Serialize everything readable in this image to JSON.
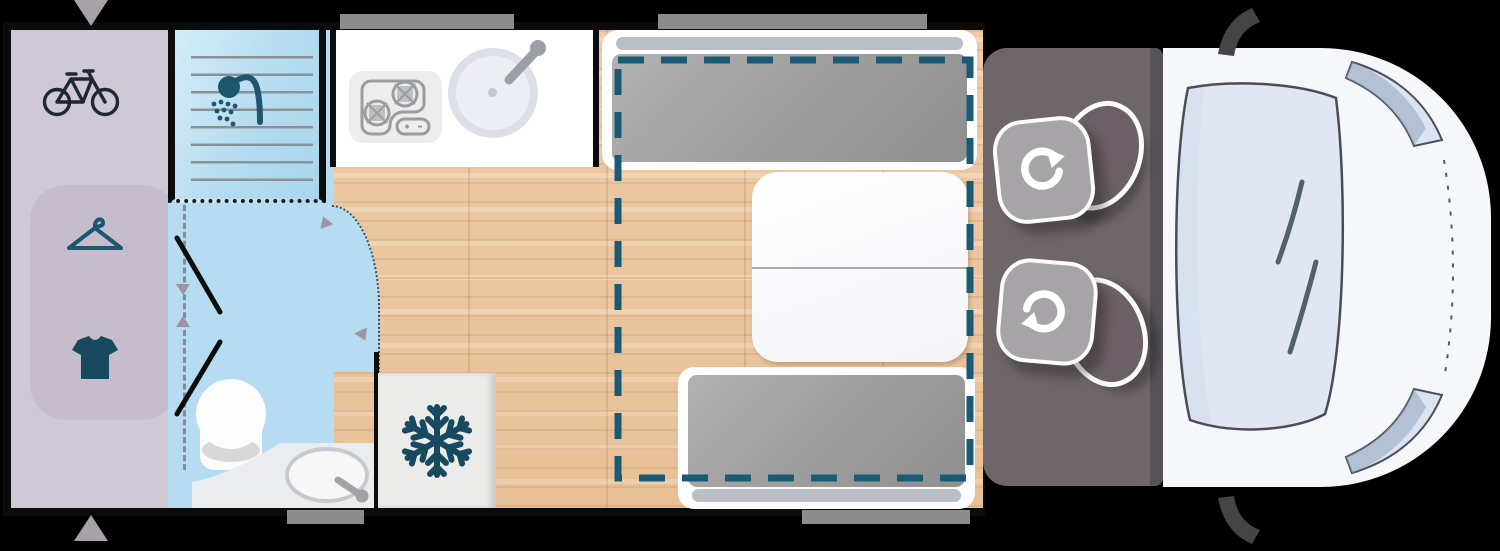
{
  "app": {
    "title": "Campervan floor plan — top view"
  },
  "colors": {
    "bg": "#000000",
    "frame": "#0b0b0b",
    "black": "#0c0c0c",
    "garage": "#cfc8d5",
    "wardrobe": "#c5bdcb",
    "arrowMarker": "#a9a1aa",
    "bath": "#b5dcf0",
    "showerLight": "#d4ecf8",
    "trackGray": "#8d8694",
    "teal": "#1d566e",
    "tealDark": "#174a5e",
    "navy": "#1f2733",
    "kitchenWhite": "#ffffff",
    "stovePanel": "#ededee",
    "stoveLine": "#9b9c9e",
    "sinkRing": "#dce0e8",
    "wood1": "#edcba6",
    "wood2": "#e7c096",
    "benchFrame": "#fdfdfd",
    "cushion": "#a0a0a0",
    "headrest": "#b9c0c5",
    "dashedBed": "#1b5a74",
    "fridge": "#ebebe9",
    "windowGray": "#8c8c8c",
    "cabFloor": "#6f6669",
    "seatBase": "#a7a4a7",
    "seatBack": "#6b6065",
    "vanBody": "#f6f7fa",
    "windshield": "#dee4f1",
    "windshieldBand": "#b4cde2",
    "outline": "#4c4c57",
    "wiper": "#51606d",
    "mirror": "#454548"
  },
  "zones": {
    "garage": {
      "label": "Rear storage / garage",
      "icons": [
        "bicycle-icon",
        "clothes-hanger-icon",
        "tshirt-icon"
      ]
    },
    "bathroom": {
      "label": "Bathroom with shower, toilet and washbasin",
      "icons": [
        "shower-icon"
      ]
    },
    "kitchen": {
      "label": "Kitchen with two-burner hob and sink"
    },
    "fridge": {
      "label": "Refrigerator",
      "icons": [
        "snowflake-icon"
      ]
    },
    "dinette": {
      "label": "Dinette with two bench seats and folding table"
    },
    "bed": {
      "label": "Drop-down bed outline"
    },
    "cab": {
      "label": "Driver cab with two swivel seats",
      "icons": [
        "rotate-icon"
      ]
    },
    "front": {
      "label": "Vehicle front with windshield, headlights and mirrors"
    }
  },
  "markers": {
    "door_top": "door-arrow-down",
    "door_bottom": "door-arrow-up",
    "sliding_door": "sliding-door-track",
    "door_swing": "door-swing-arc"
  }
}
